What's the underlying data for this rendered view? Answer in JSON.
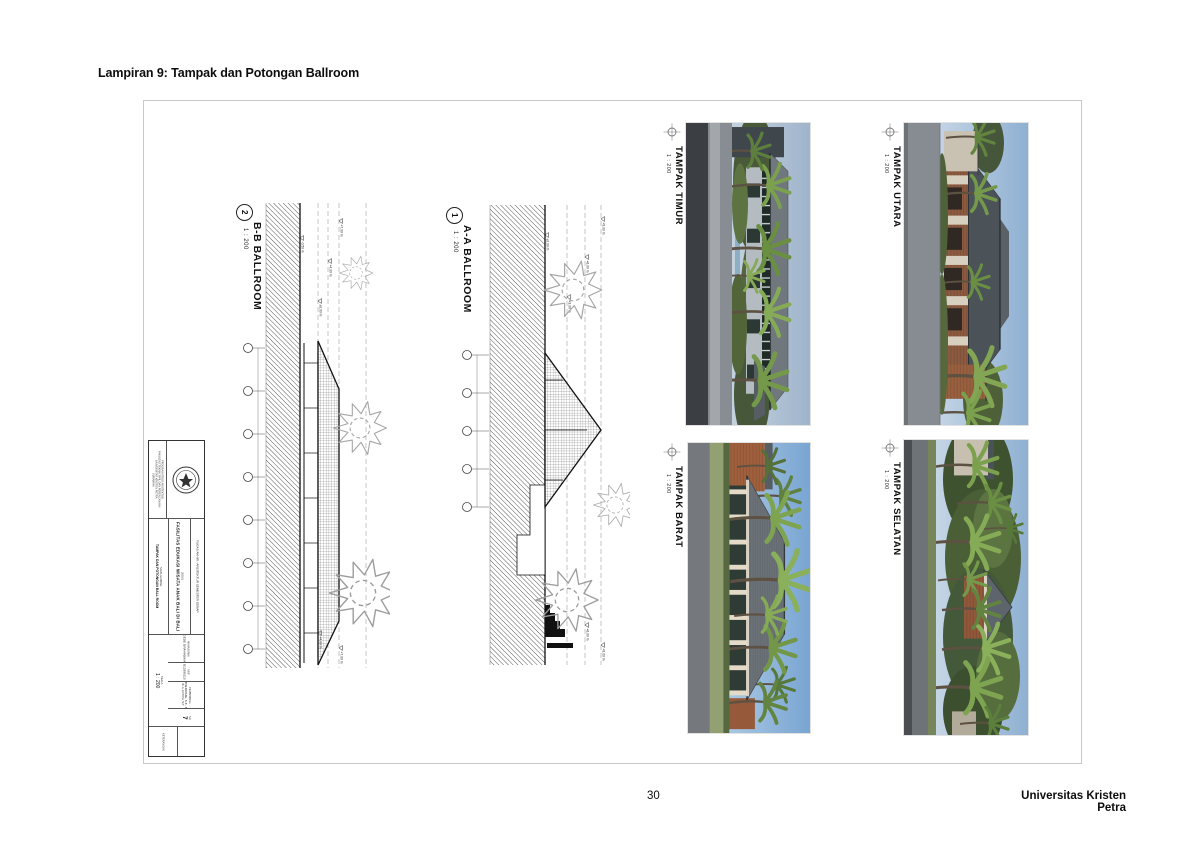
{
  "page": {
    "heading": "Lampiran 9: Tampak dan Potongan Ballroom",
    "page_number": "30",
    "footer_right": "Universitas Kristen Petra"
  },
  "sheet": {
    "sections": [
      {
        "number": "2",
        "name": "B-B BALLROOM",
        "scale": "1 : 200",
        "levels": [
          "+7.00 m",
          "+4.00 m",
          "±0.00 m",
          "-0.50 m"
        ]
      },
      {
        "number": "1",
        "name": "A-A BALLROOM",
        "scale": "1 : 200",
        "levels": [
          "+9.00 m",
          "+6.00 m",
          "+3.00 m",
          "±0.00 m"
        ]
      }
    ],
    "elevations": [
      {
        "name": "TAMPAK TIMUR",
        "scale": "1 : 200"
      },
      {
        "name": "TAMPAK UTARA",
        "scale": "1 : 200"
      },
      {
        "name": "TAMPAK BARAT",
        "scale": "1 : 200"
      },
      {
        "name": "TAMPAK SELATAN",
        "scale": "1 : 200"
      }
    ],
    "titleblock": {
      "institution_lines": [
        "PROGRAM STUDI ARSITEKTUR",
        "FAKULTAS TEKNIK SIPIL DAN PERENCANAAN",
        "UNIVERSITAS KRISTEN PETRA",
        "SURABAYA"
      ],
      "header": "TUGAS AKHIR - ARSITEKTUR SEMESTER GENAP",
      "judul_label": "JUDUL",
      "judul": "FASILITAS EDUKASI WISATA ANAK BALI DI BALI",
      "gambar_label": "NAMA GAMBAR",
      "gambar": "TAMPAK DAN POTONGAN BALL ROOM",
      "skala_label": "SKALA",
      "skala": "1 : 200",
      "mahasiswa_label": "MAHASISWA",
      "mahasiswa": "PUTU GEDE GRAHADIKA S. P.N.",
      "nrp_label": "NRP",
      "nrp": "B12990110",
      "pembimbing_label": "PEMBIMBING",
      "pembimbing": "ALTREROSJE, S.T., M.T.",
      "pembimbing2": "IR. A. ANTONI, M.T.",
      "no_label": "NO",
      "sheet_no": "7",
      "keterangan_label": "KETERANGAN"
    },
    "palette": {
      "sky": "#8fb0d2",
      "roof_dark": "#4b5359",
      "roof_gray": "#6a7177",
      "brick": "#98603f",
      "cream": "#d8d0bf",
      "foliage": "#7ba04e",
      "ground_gray": "#868c91",
      "foreground_dark": "#3b3f43",
      "linework": "#1a1a1a"
    }
  },
  "icons": {
    "north_target": "crosshair-target-icon",
    "tree_plan": "tree-scribble-icon",
    "palm": "palm-tree-icon"
  }
}
